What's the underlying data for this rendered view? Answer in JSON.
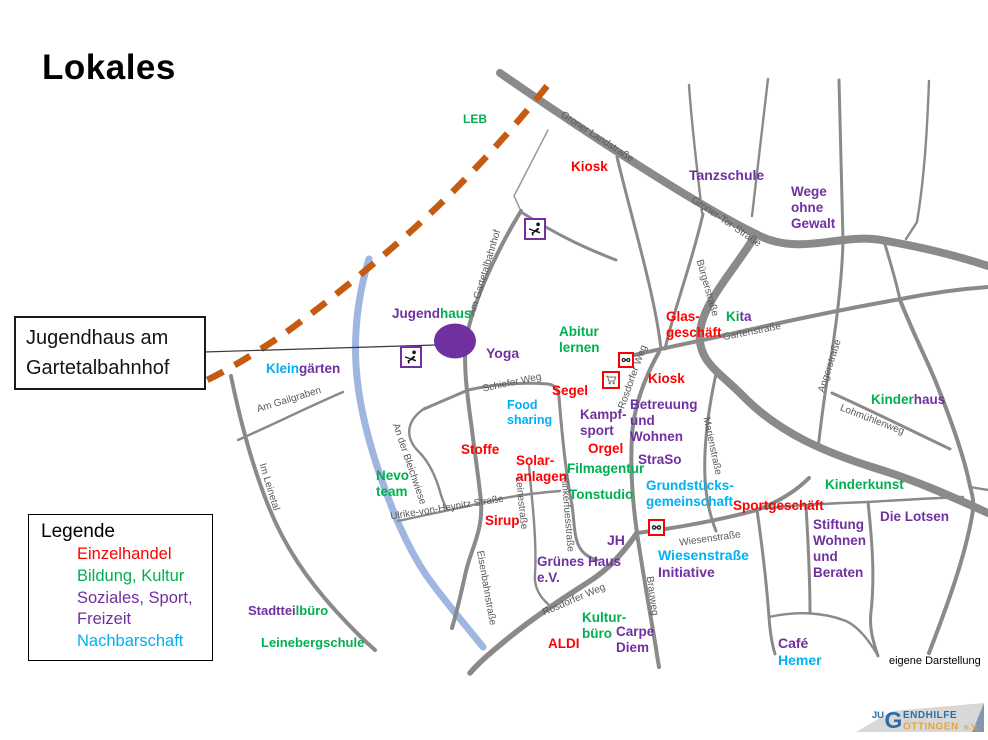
{
  "title": "Lokales",
  "callout": {
    "line1": "Jugendhaus am",
    "line2": "Gartetalbahnhof"
  },
  "legend": {
    "title": "Legende",
    "items": [
      {
        "label": "Einzelhandel",
        "color": "red"
      },
      {
        "label": "Bildung, Kultur",
        "color": "green"
      },
      {
        "label": "Soziales, Sport, Freizeit",
        "color": "purple"
      },
      {
        "label": "Nachbarschaft",
        "color": "cyan"
      }
    ]
  },
  "attribution": "eigene Darstellung",
  "logo": {
    "prefix": "JU",
    "g": "G",
    "suffix": "ENDHILFE",
    "bottom": "ÖTTINGEN",
    "ev": "e.V."
  },
  "colors": {
    "red": "#FF0000",
    "green": "#00B050",
    "purple": "#7030A0",
    "cyan": "#00B0F0",
    "street": "#595959",
    "road": "#8A8A8A",
    "river": "#9FB6E0",
    "railway": "#C55A11",
    "marker": "#7030A0"
  },
  "places": [
    {
      "n": "leb",
      "x": 463,
      "y": 112,
      "size": 12,
      "lines": [
        [
          {
            "t": "LEB",
            "c": "green"
          }
        ]
      ]
    },
    {
      "n": "kiosk-grone",
      "x": 571,
      "y": 159,
      "lines": [
        [
          {
            "t": "Kiosk",
            "c": "red"
          }
        ]
      ]
    },
    {
      "n": "tanzschule",
      "x": 689,
      "y": 167,
      "size": 14,
      "lines": [
        [
          {
            "t": "Tanzschule",
            "c": "purple"
          }
        ]
      ]
    },
    {
      "n": "wege-ohne-gewalt",
      "x": 791,
      "y": 184,
      "lines": [
        [
          {
            "t": "Wege",
            "c": "purple"
          }
        ],
        [
          {
            "t": "ohne",
            "c": "purple"
          }
        ],
        [
          {
            "t": "Gewalt",
            "c": "purple"
          }
        ]
      ]
    },
    {
      "n": "jugendhaus",
      "x": 392,
      "y": 306,
      "lines": [
        [
          {
            "t": "Jugend",
            "c": "purple"
          },
          {
            "t": "haus",
            "c": "green"
          }
        ]
      ]
    },
    {
      "n": "kleingaerten",
      "x": 266,
      "y": 361,
      "lines": [
        [
          {
            "t": "Klein",
            "c": "cyan"
          },
          {
            "t": "gärten",
            "c": "purple"
          }
        ]
      ]
    },
    {
      "n": "yoga",
      "x": 486,
      "y": 345,
      "size": 14,
      "lines": [
        [
          {
            "t": "Yoga",
            "c": "purple"
          }
        ]
      ]
    },
    {
      "n": "abitur-lernen",
      "x": 559,
      "y": 324,
      "lines": [
        [
          {
            "t": "Abitur",
            "c": "green"
          }
        ],
        [
          {
            "t": "lernen",
            "c": "green"
          }
        ]
      ]
    },
    {
      "n": "glasgeschaeft",
      "x": 666,
      "y": 309,
      "lines": [
        [
          {
            "t": "Glas-",
            "c": "red"
          }
        ],
        [
          {
            "t": "geschäft",
            "c": "red"
          }
        ]
      ]
    },
    {
      "n": "kita",
      "x": 726,
      "y": 309,
      "lines": [
        [
          {
            "t": "Ki",
            "c": "green"
          },
          {
            "t": "ta",
            "c": "purple"
          }
        ]
      ]
    },
    {
      "n": "kinderhaus",
      "x": 871,
      "y": 392,
      "lines": [
        [
          {
            "t": "Kinder",
            "c": "green"
          },
          {
            "t": "haus",
            "c": "purple"
          }
        ]
      ]
    },
    {
      "n": "segel",
      "x": 552,
      "y": 383,
      "lines": [
        [
          {
            "t": "Segel",
            "c": "red"
          }
        ]
      ]
    },
    {
      "n": "food-sharing",
      "x": 507,
      "y": 398,
      "size": 12.5,
      "lines": [
        [
          {
            "t": "Food",
            "c": "cyan"
          }
        ],
        [
          {
            "t": "sharing",
            "c": "cyan"
          }
        ]
      ]
    },
    {
      "n": "kampfsport",
      "x": 580,
      "y": 407,
      "lines": [
        [
          {
            "t": "Kampf-",
            "c": "purple"
          }
        ],
        [
          {
            "t": "sport",
            "c": "purple"
          }
        ]
      ]
    },
    {
      "n": "orgel",
      "x": 588,
      "y": 441,
      "lines": [
        [
          {
            "t": "Orgel",
            "c": "red"
          }
        ]
      ]
    },
    {
      "n": "kiosk-rosdorfer",
      "x": 648,
      "y": 371,
      "lines": [
        [
          {
            "t": "Kiosk",
            "c": "red"
          }
        ]
      ]
    },
    {
      "n": "betreuung-und-wohnen",
      "x": 630,
      "y": 397,
      "lines": [
        [
          {
            "t": "Betreuung",
            "c": "purple"
          }
        ],
        [
          {
            "t": "und",
            "c": "purple"
          }
        ],
        [
          {
            "t": "Wohnen",
            "c": "purple"
          }
        ]
      ]
    },
    {
      "n": "straso",
      "x": 638,
      "y": 452,
      "lines": [
        [
          {
            "t": "StraSo",
            "c": "purple"
          }
        ]
      ]
    },
    {
      "n": "stoffe",
      "x": 461,
      "y": 442,
      "lines": [
        [
          {
            "t": "Stoffe",
            "c": "red"
          }
        ]
      ]
    },
    {
      "n": "solaranlagen",
      "x": 516,
      "y": 453,
      "lines": [
        [
          {
            "t": "Solar-",
            "c": "red"
          }
        ],
        [
          {
            "t": "anlagen",
            "c": "red"
          }
        ]
      ]
    },
    {
      "n": "filmagentur",
      "x": 567,
      "y": 461,
      "lines": [
        [
          {
            "t": "Filmagentur",
            "c": "green"
          }
        ]
      ]
    },
    {
      "n": "tonstudio",
      "x": 569,
      "y": 487,
      "lines": [
        [
          {
            "t": "Tonstudio",
            "c": "green"
          }
        ]
      ]
    },
    {
      "n": "grundstuecksgemeinschaft",
      "x": 646,
      "y": 478,
      "lines": [
        [
          {
            "t": "Grundstücks-",
            "c": "cyan"
          }
        ],
        [
          {
            "t": "gemeinschaft",
            "c": "cyan"
          }
        ]
      ]
    },
    {
      "n": "nevo-team",
      "x": 376,
      "y": 468,
      "lines": [
        [
          {
            "t": "Nevo",
            "c": "green"
          }
        ],
        [
          {
            "t": "team",
            "c": "green"
          }
        ]
      ]
    },
    {
      "n": "sirup",
      "x": 485,
      "y": 513,
      "lines": [
        [
          {
            "t": "Sirup",
            "c": "red"
          }
        ]
      ]
    },
    {
      "n": "gruenes-haus",
      "x": 537,
      "y": 554,
      "lines": [
        [
          {
            "t": "Grünes Haus",
            "c": "purple"
          }
        ],
        [
          {
            "t": "e.V.",
            "c": "purple"
          }
        ]
      ]
    },
    {
      "n": "jh",
      "x": 607,
      "y": 532,
      "size": 14,
      "lines": [
        [
          {
            "t": "JH",
            "c": "purple"
          }
        ]
      ]
    },
    {
      "n": "wiesenstrasse-initiative",
      "x": 658,
      "y": 547,
      "size": 14,
      "lines": [
        [
          {
            "t": "Wiesenstraße",
            "c": "cyan"
          }
        ],
        [
          {
            "t": "Initiative",
            "c": "purple"
          }
        ]
      ]
    },
    {
      "n": "kulturbuero",
      "x": 582,
      "y": 610,
      "lines": [
        [
          {
            "t": "Kultur-",
            "c": "green"
          }
        ],
        [
          {
            "t": "büro",
            "c": "green"
          }
        ]
      ]
    },
    {
      "n": "carpe-diem",
      "x": 616,
      "y": 624,
      "lines": [
        [
          {
            "t": "Carpe",
            "c": "purple"
          }
        ],
        [
          {
            "t": "Diem",
            "c": "purple"
          }
        ]
      ]
    },
    {
      "n": "aldi",
      "x": 548,
      "y": 636,
      "lines": [
        [
          {
            "t": "ALDI",
            "c": "red"
          }
        ]
      ]
    },
    {
      "n": "sportgeschaeft",
      "x": 733,
      "y": 498,
      "lines": [
        [
          {
            "t": "Sportgeschäft",
            "c": "red"
          }
        ]
      ]
    },
    {
      "n": "kinderkunst",
      "x": 825,
      "y": 477,
      "lines": [
        [
          {
            "t": "Kinderkunst",
            "c": "green"
          }
        ]
      ]
    },
    {
      "n": "die-lotsen",
      "x": 880,
      "y": 509,
      "lines": [
        [
          {
            "t": "Die Lotsen",
            "c": "purple"
          }
        ]
      ]
    },
    {
      "n": "stiftung-wohnen-und-beraten",
      "x": 813,
      "y": 517,
      "lines": [
        [
          {
            "t": "Stiftung",
            "c": "purple"
          }
        ],
        [
          {
            "t": "Wohnen",
            "c": "purple"
          }
        ],
        [
          {
            "t": "und",
            "c": "purple"
          }
        ],
        [
          {
            "t": "Beraten",
            "c": "purple"
          }
        ]
      ]
    },
    {
      "n": "cafe-hemer",
      "x": 778,
      "y": 635,
      "size": 14,
      "lines": [
        [
          {
            "t": "Café",
            "c": "purple"
          }
        ],
        [
          {
            "t": "Hemer",
            "c": "cyan"
          }
        ]
      ]
    },
    {
      "n": "stadtteilbuero",
      "x": 248,
      "y": 603,
      "size": 13,
      "lines": [
        [
          {
            "t": "Stadttei",
            "c": "purple"
          },
          {
            "t": "lbüro",
            "c": "green"
          }
        ]
      ]
    },
    {
      "n": "leinebergschule",
      "x": 261,
      "y": 635,
      "size": 13,
      "lines": [
        [
          {
            "t": "Leinebergschule",
            "c": "green"
          }
        ]
      ]
    }
  ],
  "streets": [
    {
      "name": "Groner Landstraße",
      "cx": 597,
      "cy": 137,
      "rot": 33
    },
    {
      "name": "Groner-Tor-Straße",
      "cx": 726,
      "cy": 222,
      "rot": 34
    },
    {
      "name": "Bürgerstraße",
      "cx": 707,
      "cy": 288,
      "rot": 74
    },
    {
      "name": "Am Gartetalbahnhof",
      "cx": 485,
      "cy": 273,
      "rot": -73
    },
    {
      "name": "Schiefer Weg",
      "cx": 512,
      "cy": 383,
      "rot": -12
    },
    {
      "name": "Gartenstraße",
      "cx": 752,
      "cy": 332,
      "rot": -11
    },
    {
      "name": "Rosdorfer Weg",
      "cx": 633,
      "cy": 377,
      "rot": -70
    },
    {
      "name": "Angerstraße",
      "cx": 830,
      "cy": 366,
      "rot": -72
    },
    {
      "name": "Marienstraße",
      "cx": 712,
      "cy": 446,
      "rot": 78
    },
    {
      "name": "Lohmühlenweg",
      "cx": 872,
      "cy": 420,
      "rot": 21
    },
    {
      "name": "Wiesenstraße",
      "cx": 710,
      "cy": 539,
      "rot": -8
    },
    {
      "name": "Brauweg",
      "cx": 652,
      "cy": 596,
      "rot": 82
    },
    {
      "name": "Rosdorfer Weg",
      "cx": 574,
      "cy": 600,
      "rot": -23
    },
    {
      "name": "Leinestraße",
      "cx": 521,
      "cy": 503,
      "rot": 84
    },
    {
      "name": "Klinkerfuesstraße",
      "cx": 567,
      "cy": 513,
      "rot": 85
    },
    {
      "name": "Eisenbahnstraße",
      "cx": 486,
      "cy": 588,
      "rot": 80
    },
    {
      "name": "Ulrike-von-Heynitz Straße",
      "cx": 447,
      "cy": 508,
      "rot": -9
    },
    {
      "name": "An der Bleichwiese",
      "cx": 409,
      "cy": 464,
      "rot": 71
    },
    {
      "name": "Am Gailgraben",
      "cx": 289,
      "cy": 400,
      "rot": -17
    },
    {
      "name": "Im Leinetal",
      "cx": 269,
      "cy": 487,
      "rot": 73
    }
  ],
  "icons": [
    {
      "type": "dancer-icon",
      "x": 524,
      "y": 218,
      "size": 22,
      "border": "purple"
    },
    {
      "type": "dancer-icon",
      "x": 400,
      "y": 346,
      "size": 22,
      "border": "purple"
    },
    {
      "type": "glasses-icon",
      "x": 618,
      "y": 352,
      "size": 16,
      "border": "red"
    },
    {
      "type": "cart-icon",
      "x": 602,
      "y": 371,
      "size": 18,
      "border": "red"
    },
    {
      "type": "glasses-icon",
      "x": 648,
      "y": 519,
      "size": 17,
      "border": "red"
    }
  ]
}
